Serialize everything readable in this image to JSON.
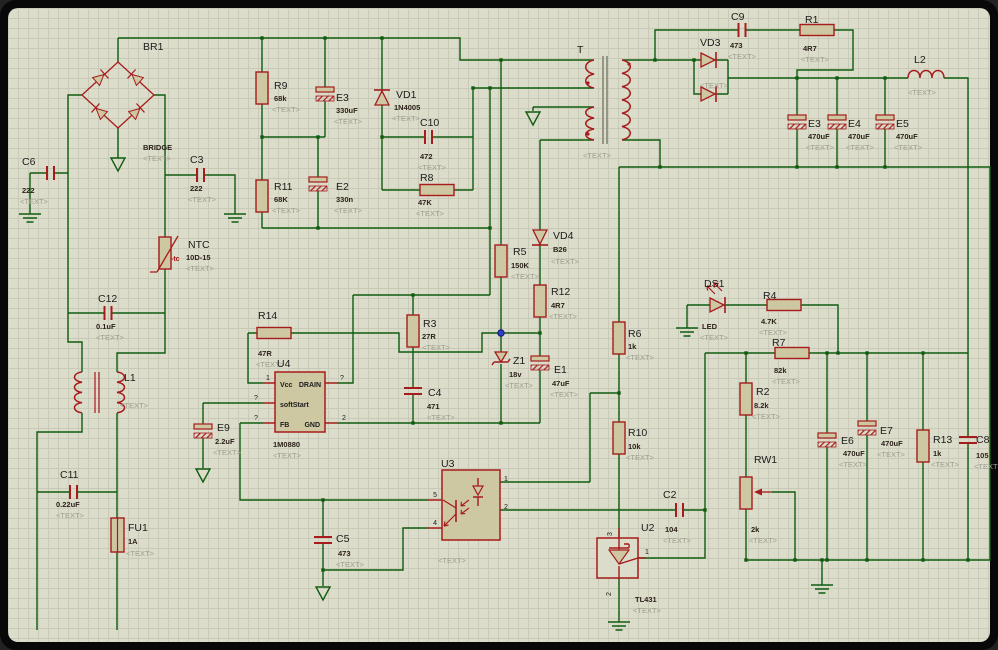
{
  "ui": {
    "placeholder": "<TEXT>",
    "colors": {
      "wire": "#0f5c0f",
      "part_outline": "#a61b1b",
      "part_fill": "#cdc8a2",
      "sheet": "#dcdccb",
      "grid": "#c9c9b7",
      "frame": "#080808",
      "marker": "#2f3fbf"
    }
  },
  "components": {
    "BR1": {
      "ref": "BR1",
      "val": "BRIDGE"
    },
    "C6": {
      "ref": "C6",
      "val": "222"
    },
    "C3": {
      "ref": "C3",
      "val": "222"
    },
    "NTC": {
      "ref": "NTC",
      "val": "10D-15",
      "tc": "-tc"
    },
    "C12": {
      "ref": "C12",
      "val": "0.1uF"
    },
    "L1": {
      "ref": "L1"
    },
    "C11": {
      "ref": "C11",
      "val": "0.22uF"
    },
    "FU1": {
      "ref": "FU1",
      "val": "1A"
    },
    "E9": {
      "ref": "E9",
      "val": "2.2uF"
    },
    "R9": {
      "ref": "R9",
      "val": "68k"
    },
    "E3a": {
      "ref": "E3",
      "val": "330uF"
    },
    "VD1": {
      "ref": "VD1",
      "val": "1N4005"
    },
    "R11": {
      "ref": "R11",
      "val": "68K"
    },
    "E2": {
      "ref": "E2",
      "val": "330n"
    },
    "C10": {
      "ref": "C10",
      "val": "472"
    },
    "R8": {
      "ref": "R8",
      "val": "47K"
    },
    "R14": {
      "ref": "R14",
      "val": "47R"
    },
    "U4": {
      "ref": "U4",
      "val": "1M0880",
      "pin_labels": {
        "vcc": "Vcc",
        "drain": "DRAIN",
        "soft": "softStart",
        "fb": "FB",
        "gnd": "GND"
      },
      "pins": {
        "n1": "1",
        "q1": "?",
        "q2": "?",
        "q3": "?",
        "n2": "2"
      }
    },
    "R3": {
      "ref": "R3",
      "val": "27R"
    },
    "C4": {
      "ref": "C4",
      "val": "471"
    },
    "T": {
      "ref": "T"
    },
    "R5": {
      "ref": "R5",
      "val": "150K"
    },
    "VD4": {
      "ref": "VD4",
      "val": "B26"
    },
    "R12": {
      "ref": "R12",
      "val": "4R7"
    },
    "Z1": {
      "ref": "Z1",
      "val": "18v"
    },
    "E1": {
      "ref": "E1",
      "val": "47uF"
    },
    "R6": {
      "ref": "R6",
      "val": "1k"
    },
    "R10": {
      "ref": "R10",
      "val": "10k"
    },
    "C9": {
      "ref": "C9",
      "val": "473"
    },
    "R1": {
      "ref": "R1",
      "val": "4R7"
    },
    "VD3": {
      "ref": "VD3"
    },
    "L2": {
      "ref": "L2"
    },
    "E3b": {
      "ref": "E3",
      "val": "470uF"
    },
    "E4": {
      "ref": "E4",
      "val": "470uF"
    },
    "E5": {
      "ref": "E5",
      "val": "470uF"
    },
    "DS1": {
      "ref": "DS1",
      "val": "LED"
    },
    "R4": {
      "ref": "R4",
      "val": "4.7K"
    },
    "R7": {
      "ref": "R7",
      "val": "82k"
    },
    "R2": {
      "ref": "R2",
      "val": "8.2k"
    },
    "RW1": {
      "ref": "RW1",
      "val": "2k"
    },
    "E6": {
      "ref": "E6",
      "val": "470uF"
    },
    "E7": {
      "ref": "E7",
      "val": "470uF"
    },
    "R13": {
      "ref": "R13",
      "val": "1k"
    },
    "C8": {
      "ref": "C8",
      "val": "105"
    },
    "U3": {
      "ref": "U3",
      "pins": {
        "p5": "5",
        "p4": "4",
        "p1": "1",
        "p2": "2"
      }
    },
    "C5": {
      "ref": "C5",
      "val": "473"
    },
    "C2": {
      "ref": "C2",
      "val": "104"
    },
    "U2": {
      "ref": "U2",
      "val": "TL431",
      "pins": {
        "p3": "3",
        "p1": "1",
        "p2": "2"
      }
    }
  }
}
